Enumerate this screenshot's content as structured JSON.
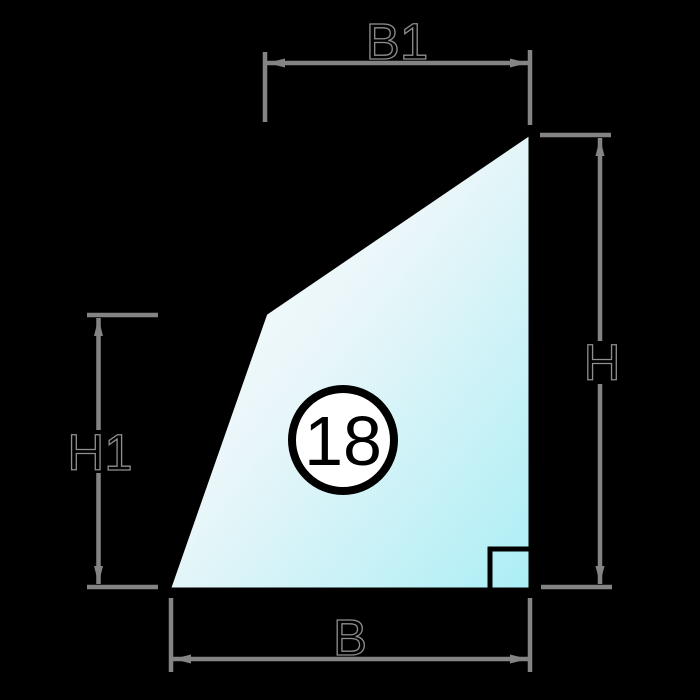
{
  "diagram": {
    "badge": {
      "value": "18"
    },
    "dimension_labels": {
      "top_width": "B1",
      "right_height": "H",
      "left_height": "H1",
      "bottom_width": "B"
    },
    "colors": {
      "background": "#000000",
      "shape_outline": "#000000",
      "glass_gradient_start": "#fdfefe",
      "glass_gradient_mid": "#e9f6f9",
      "glass_gradient_end": "#abeef5",
      "dimension_line": "#848484",
      "label_fill": "#000000",
      "label_outline": "#8f8f8f",
      "badge_fill": "#ffffff",
      "badge_stroke": "#000000",
      "badge_text": "#000000"
    }
  }
}
